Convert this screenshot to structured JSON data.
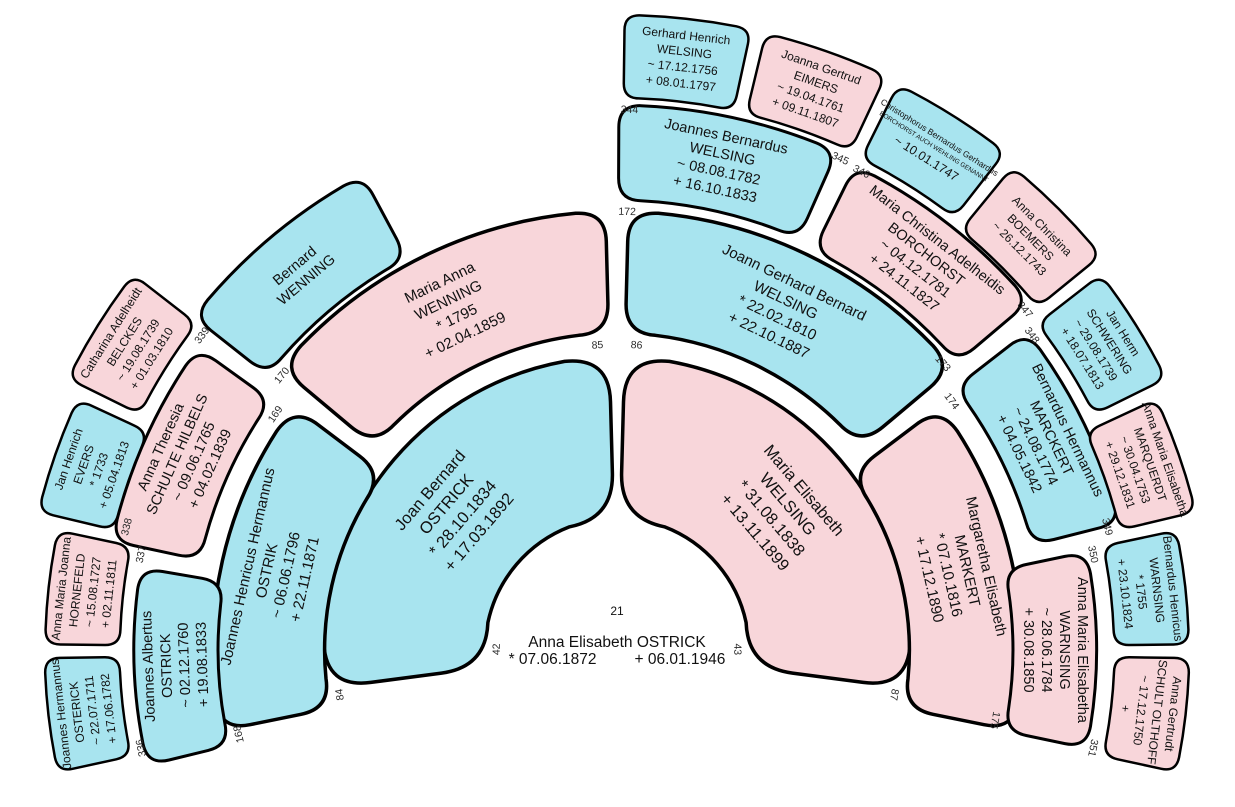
{
  "chart": {
    "type": "genealogy-fan-chart",
    "background": "#ffffff",
    "colors": {
      "male": "#a8e4ef",
      "female": "#f8d6da",
      "outline": "#000000",
      "number_text": "#2b2b2b",
      "label_text": "#111111"
    },
    "center_person": {
      "number": "21",
      "name": "Anna Elisabeth OSTRICK",
      "birth": "* 07.06.1872",
      "death": "+ 06.01.1946"
    },
    "persons": [
      {
        "number": "42",
        "sex": "male",
        "lines": [
          "Joan Bernard",
          "OSTRICK",
          "* 28.10.1834",
          "+ 17.03.1892"
        ]
      },
      {
        "number": "43",
        "sex": "female",
        "lines": [
          "Maria Elisabeth",
          "WELSING",
          "* 31.08.1838",
          "+ 13.11.1899"
        ]
      },
      {
        "number": "84",
        "sex": "male",
        "lines": [
          "Joannes Henricus Hermannus",
          "OSTRIK",
          "~ 06.06.1796",
          "+ 22.11.1871"
        ]
      },
      {
        "number": "85",
        "sex": "female",
        "lines": [
          "Maria Anna",
          "WENNING",
          "* 1795",
          "+ 02.04.1859"
        ]
      },
      {
        "number": "86",
        "sex": "male",
        "lines": [
          "Joann Gerhard Bernard",
          "WELSING",
          "* 22.02.1810",
          "+ 22.10.1887"
        ]
      },
      {
        "number": "87",
        "sex": "female",
        "lines": [
          "Margaretha Elisabeth",
          "MARKERT",
          "* 07.10.1816",
          "+ 17.12.1890"
        ]
      },
      {
        "number": "168",
        "sex": "male",
        "lines": [
          "Joannes Albertus",
          "OSTRICK",
          "~ 02.12.1760",
          "+ 19.08.1833"
        ]
      },
      {
        "number": "169",
        "sex": "female",
        "lines": [
          "Anna Theresia",
          "SCHULTE HILBELS",
          "~ 09.06.1765",
          "+ 04.02.1839"
        ]
      },
      {
        "number": "170",
        "sex": "male",
        "lines": [
          "Bernard",
          "WENNING"
        ]
      },
      {
        "number": "172",
        "sex": "male",
        "lines": [
          "Joannes Bernardus",
          "WELSING",
          "~ 08.08.1782",
          "+ 16.10.1833"
        ]
      },
      {
        "number": "173",
        "sex": "female",
        "lines": [
          "Maria Christina Adelheidis",
          "BORCHORST",
          "~ 04.12.1781",
          "+ 24.11.1827"
        ]
      },
      {
        "number": "174",
        "sex": "male",
        "lines": [
          "Bernardus Hermannus",
          "MARCKERT",
          "~ 24.08.1774",
          "+ 04.05.1842"
        ]
      },
      {
        "number": "175",
        "sex": "female",
        "lines": [
          "Anna Maria Elisabetha",
          "WARNSING",
          "~ 28.06.1784",
          "+ 30.08.1850"
        ]
      },
      {
        "number": "336",
        "sex": "male",
        "lines": [
          "Joannes Hermannus",
          "OSTERICK",
          "~ 22.07.1711",
          "+ 17.06.1782"
        ]
      },
      {
        "number": "337",
        "sex": "female",
        "lines": [
          "Anna Maria Joanna",
          "HORNEFELD",
          "~ 15.08.1727",
          "+ 02.11.1811"
        ]
      },
      {
        "number": "338",
        "sex": "male",
        "lines": [
          "Jan Henrich",
          "EVERS",
          "* 1733",
          "+ 05.04.1813"
        ]
      },
      {
        "number": "339",
        "sex": "female",
        "lines": [
          "Catharina Adelheidt",
          "BELCKES",
          "~ 19.08.1739",
          "+ 01.03.1810"
        ]
      },
      {
        "number": "344",
        "sex": "male",
        "lines": [
          "Gerhard Henrich",
          "WELSING",
          "~ 17.12.1756",
          "+ 08.01.1797"
        ]
      },
      {
        "number": "345",
        "sex": "female",
        "lines": [
          "Joanna Gertrud",
          "EIMERS",
          "~ 19.04.1761",
          "+ 09.11.1807"
        ]
      },
      {
        "number": "346",
        "sex": "male",
        "lines": [
          "Christophorus Bernardus Gerhardus",
          "BORCHORST AUCH WEHLING GENANNT",
          "~ 10.01.1747"
        ]
      },
      {
        "number": "347",
        "sex": "female",
        "lines": [
          "Anna Christina",
          "BOEMERS",
          "~ 26.12.1743"
        ]
      },
      {
        "number": "348",
        "sex": "male",
        "lines": [
          "Jan Herm",
          "SCHWERING",
          "~ 29.08.1739",
          "+ 18.07.1813"
        ]
      },
      {
        "number": "349",
        "sex": "female",
        "lines": [
          "Anna Maria Elisabetha",
          "MARQUERDT",
          "~ 30.04.1753",
          "+ 29.12.1831"
        ]
      },
      {
        "number": "350",
        "sex": "male",
        "lines": [
          "Bernardus Henricus",
          "WARNSING",
          "* 1755",
          "+ 23.10.1824"
        ]
      },
      {
        "number": "351",
        "sex": "female",
        "lines": [
          "Anna Gertrudt",
          "SCHULT OLTHOFF",
          "~ 17.12.1750",
          "+"
        ]
      }
    ]
  }
}
